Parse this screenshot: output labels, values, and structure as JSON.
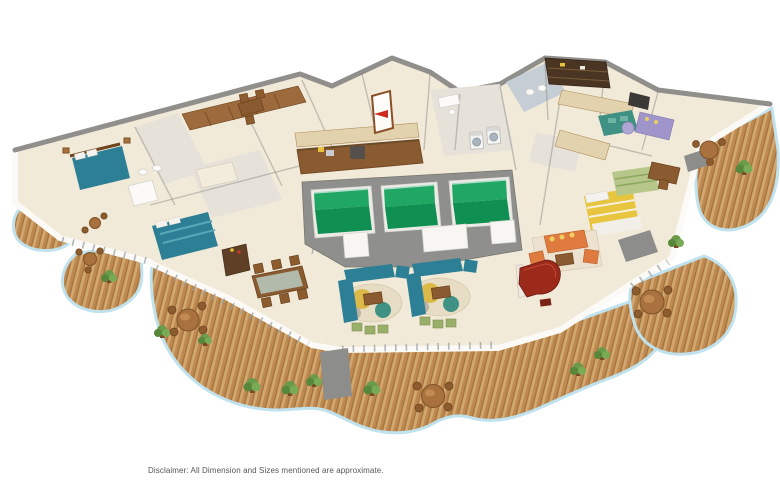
{
  "page": {
    "background": "#ffffff",
    "disclaimer": "Disclaimer: All Dimension and Sizes mentioned are approximate."
  },
  "palette": {
    "page-bg": "#ffffff",
    "deck-wood": "#bd8950",
    "deck-wood-light": "#d2a770",
    "deck-plank": "#9e7039",
    "rail-glass": "#bfe2ee",
    "floor-cream": "#f2ead9",
    "floor-tile": "#e6e2da",
    "floor-tile-blue": "#c5ced4",
    "wall-grey": "#908f8b",
    "wall-white": "#fbfaf7",
    "pool-water": "#1fa763",
    "pool-water-deep": "#108f52",
    "pool-deck": "#8f8f8d",
    "teal-fabric": "#2d7f95",
    "orange-fabric": "#e07b3f",
    "purple-fabric": "#a095cb",
    "yellow-fabric": "#e7c53f",
    "green-stripe": "#b7c789",
    "piano-red": "#9b2a1b",
    "wood-brown": "#8a5a30",
    "wood-dark": "#6e441f",
    "cafe-table": "#a9713d",
    "plant-green": "#6b9b4a",
    "plant-green-dark": "#57873a",
    "rug-teal": "#3f9184",
    "rug-yellow": "#ddb94a",
    "mat-grey": "#8d8d8b",
    "arrow-red": "#cc2a1e",
    "text-grey": "#55565a"
  },
  "floorplan": {
    "view": "isometric-3d-render",
    "features": [
      {
        "id": "plunge-pools",
        "count": 3,
        "color_key": "pool-water"
      },
      {
        "id": "kitchen-counter",
        "count": 1
      },
      {
        "id": "dining-table-8-seat",
        "count": 1
      },
      {
        "id": "teal-sofa-lounge",
        "count": 2
      },
      {
        "id": "orange-sofa-set",
        "count": 1
      },
      {
        "id": "purple-sofa-lounge",
        "count": 1
      },
      {
        "id": "grand-piano",
        "count": 1,
        "color_key": "piano-red"
      },
      {
        "id": "bed-teal",
        "count": 2
      },
      {
        "id": "bed-yellow-striped",
        "count": 1
      },
      {
        "id": "bed-green-striped",
        "count": 1
      },
      {
        "id": "washing-machine",
        "count": 2
      },
      {
        "id": "bathtub",
        "count": 2
      },
      {
        "id": "entrance-door-red-arrow",
        "count": 1
      },
      {
        "id": "wrap-around-wood-deck",
        "count": 5
      },
      {
        "id": "deck-cafe-table",
        "count": 6
      },
      {
        "id": "potted-plant",
        "count": 11
      }
    ]
  }
}
